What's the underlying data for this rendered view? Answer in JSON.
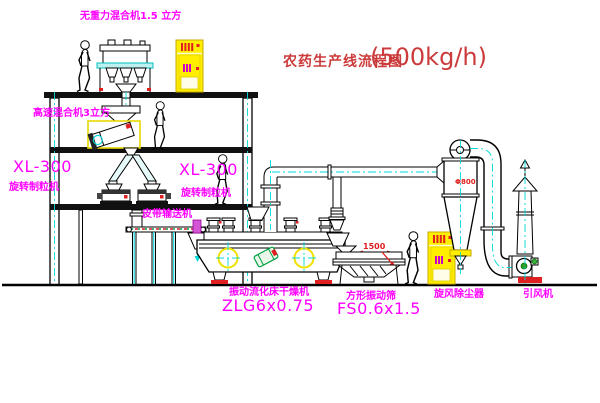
{
  "title": {
    "text": "农药生产线流程图",
    "capacity": "(500kg/h)"
  },
  "labels": {
    "gravity_mixer": "无重力混合机1.5 立方",
    "high_speed_mixer": "高速混合机3立方",
    "granulator_left_model": "XL-300",
    "granulator_left_name": "旋转制粒机",
    "granulator_center_model": "XL-300",
    "granulator_center_name": "旋转制粒机",
    "belt_conveyor": "皮带输送机",
    "dryer_name": "振动流化床干燥机",
    "dryer_model": "ZLG6x0.75",
    "screen_name": "方形振动筛",
    "screen_model": "FS0.6x1.5",
    "cyclone": "旋风除尘器",
    "induced_draft_fan": "引风机"
  },
  "dimensions": {
    "screen_length": "1500",
    "cyclone_diameter": "Φ800"
  },
  "colors": {
    "label_magenta": "#ff00ff",
    "title_red": "#cc3b3b",
    "centerline_cyan": "#00d8d8",
    "equipment_yellow": "#ffee00",
    "accent_red": "#e02020",
    "accent_green": "#00a040",
    "line_black": "#000000"
  }
}
